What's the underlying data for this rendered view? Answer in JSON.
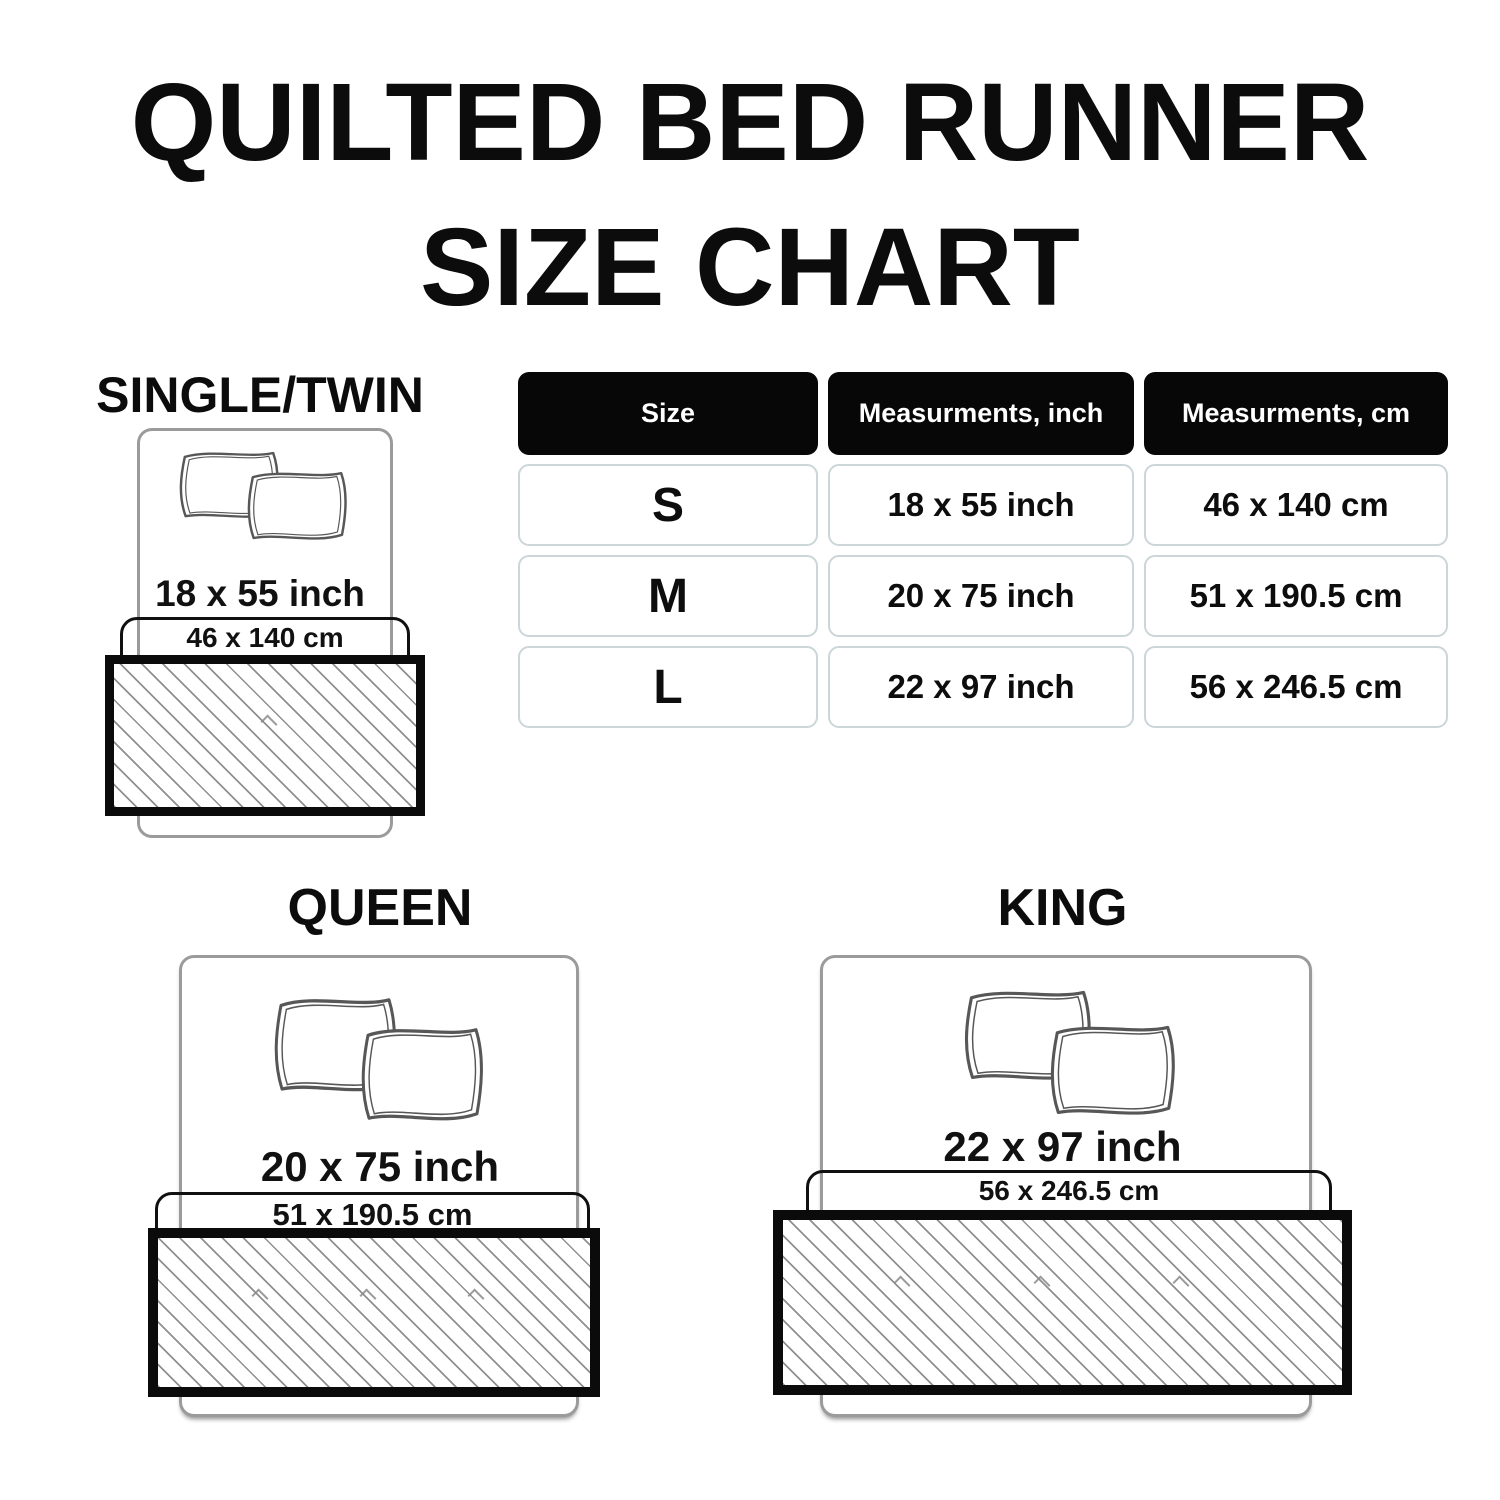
{
  "title": {
    "line1": "QUILTED BED RUNNER",
    "line2": "SIZE CHART"
  },
  "table": {
    "headers": [
      "Size",
      "Measurments, inch",
      "Measurments, cm"
    ],
    "rows": [
      {
        "size": "S",
        "inch": "18 x 55 inch",
        "cm": "46 x 140 cm"
      },
      {
        "size": "M",
        "inch": "20 x 75 inch",
        "cm": "51 x 190.5 cm"
      },
      {
        "size": "L",
        "inch": "22 x 97 inch",
        "cm": "56 x 246.5 cm"
      }
    ]
  },
  "diagrams": [
    {
      "label": "SINGLE/TWIN",
      "inch": "18 x 55 inch",
      "cm": "46 x 140 cm"
    },
    {
      "label": "QUEEN",
      "inch": "20 x 75 inch",
      "cm": "51 x 190.5 cm"
    },
    {
      "label": "KING",
      "inch": "22 x 97 inch",
      "cm": "56 x 246.5 cm"
    }
  ],
  "colors": {
    "text": "#0c0c0c",
    "table_header_bg": "#070707",
    "table_header_text": "#ffffff",
    "cell_border": "#ccd6d9",
    "bed_outline": "#9b9b9b",
    "pillow_outline": "#575757",
    "runner_border": "#0b0b0b",
    "hatch_line": "#8f8f8f"
  }
}
